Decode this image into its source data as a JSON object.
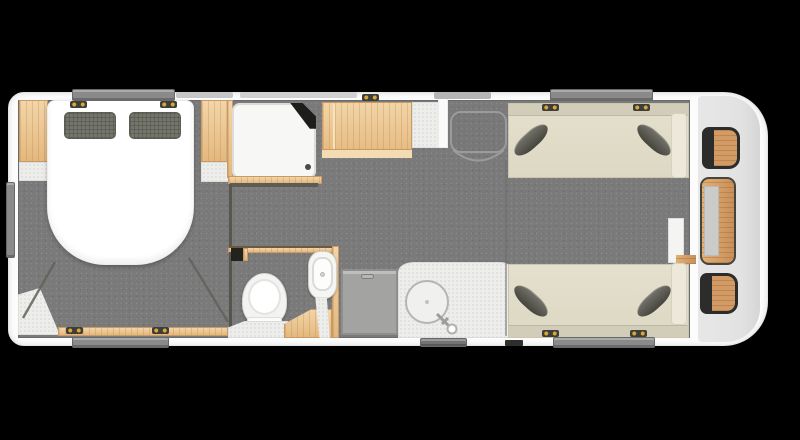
{
  "meta": {
    "title": "Caravan floor plan - top-down layout view",
    "view": "top-down",
    "style": "rendered 3D floorplan"
  },
  "colors": {
    "background": "#000000",
    "shell_wall": "#fcfcfc",
    "floor": "#7a7a7a",
    "wood": "#ecc795",
    "sofa_beige": "#e0dcc8",
    "cushion_dark": "#55554d",
    "pillow": "#73756b",
    "worktop_speckle": "#ededeb",
    "endcap_gray": "#e4e4e4",
    "window_gray": "#8a8a8a",
    "seat_wood": "#d29a64",
    "seat_frame": "#2c2c2a",
    "hinge_gold": "#d9a834"
  },
  "areas": {
    "bedroom": {
      "label": "Bedroom with island double bed",
      "fixtures": [
        "double-bed",
        "pillow x2",
        "wardrobe left",
        "wardrobe right",
        "bedside shelves",
        "bed-box bench",
        "window top",
        "window bottom",
        "window side"
      ]
    },
    "shower": {
      "label": "Shower cubicle",
      "fixtures": [
        "shower tray",
        "corner shower unit",
        "drain"
      ]
    },
    "kitchen": {
      "label": "Kitchen",
      "fixtures": [
        "overhead unit",
        "worktop",
        "round sink",
        "tap",
        "appliance / fridge"
      ]
    },
    "washroom": {
      "label": "Washroom",
      "fixtures": [
        "toilet",
        "pedestal basin",
        "corner vanity step"
      ]
    },
    "entrance": {
      "label": "Entrance door with swing arc"
    },
    "lounge": {
      "label": "Lounge with facing sofas",
      "fixtures": [
        "sofa top",
        "sofa bottom",
        "scatter cushion x4",
        "armrests",
        "side pillar"
      ]
    },
    "front": {
      "label": "Front end with chest table and seats",
      "fixtures": [
        "seat top",
        "chest table with runner",
        "seat bottom"
      ]
    }
  }
}
